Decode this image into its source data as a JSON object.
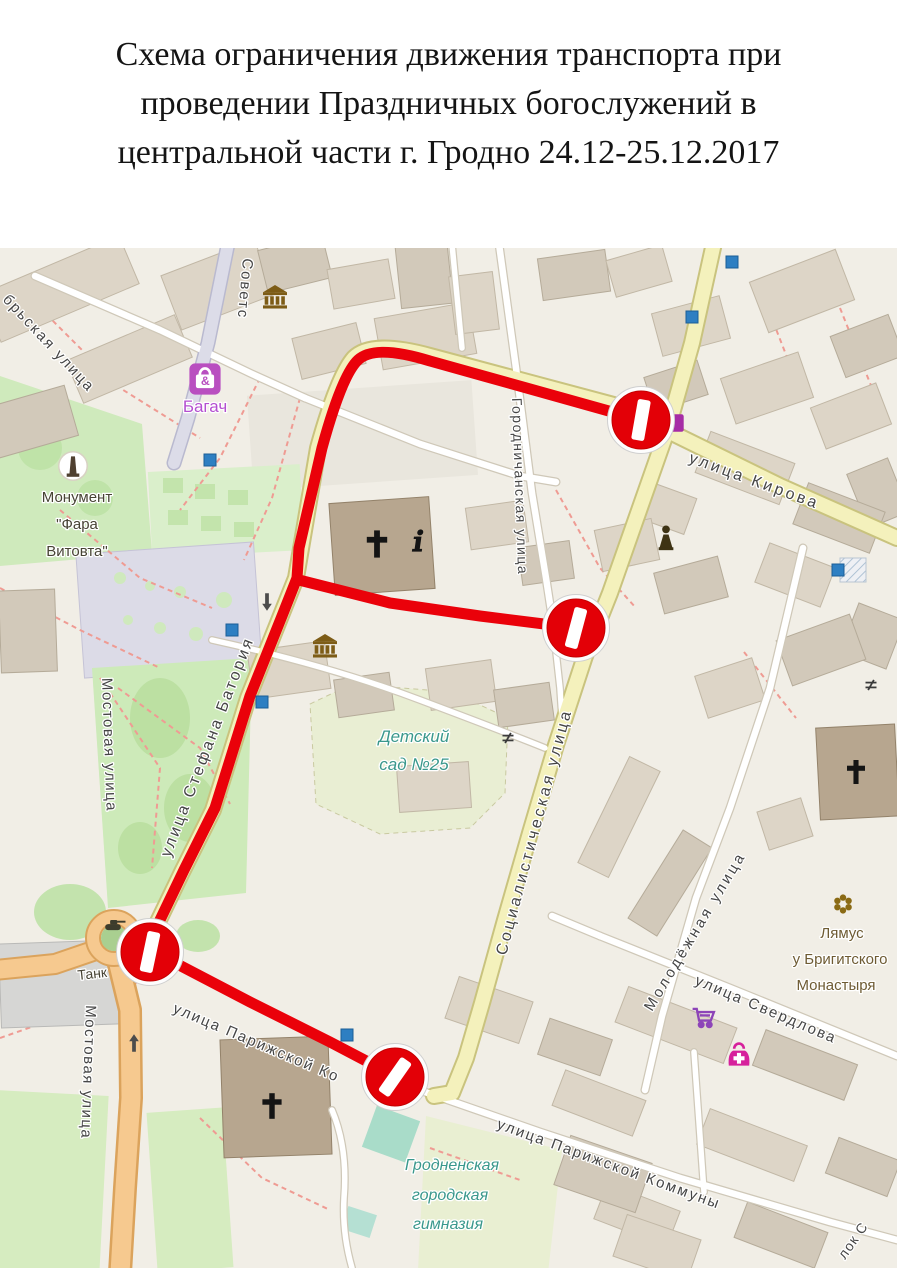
{
  "title": {
    "lines": [
      "Схема ограничения движения транспорта при",
      "проведении Праздничных богослужений в",
      "центральной части г. Гродно 24.12-25.12.2017"
    ]
  },
  "map": {
    "colors": {
      "street_text": "#454545",
      "poi_teal": "#3a988c",
      "poi_purple": "#b44fd0",
      "poi_brown": "#6e5b33",
      "poi_dark": "#474334",
      "route_red": "#ea010a",
      "sign_red": "#e30007"
    },
    "route": {
      "width": 11,
      "paths": [
        "M641,172 L430,113 Q375,96 358,112 Q342,127 322,200 L299,300 L297,330 L282,368 L250,448 L215,560 L184,622 L160,672 L152,700",
        "M299,332 L390,355 L480,368 L576,380",
        "M158,706 L250,754 L330,794 L393,827"
      ]
    },
    "no_entry_signs": [
      {
        "x": 641,
        "y": 172,
        "bar_rotate": 10
      },
      {
        "x": 576,
        "y": 380,
        "bar_rotate": 15
      },
      {
        "x": 150,
        "y": 704,
        "bar_rotate": 12
      },
      {
        "x": 395,
        "y": 829,
        "bar_rotate": 35
      }
    ],
    "labels": [
      {
        "name": "street-oktyabrskaya",
        "text": "брьская улица",
        "x": 2,
        "y": 52,
        "r": 47,
        "size": 15,
        "color": "street_text",
        "ls": 2
      },
      {
        "name": "street-sovetskaya",
        "text": "Советс",
        "x": 243,
        "y": 10,
        "r": 95,
        "size": 15,
        "color": "street_text",
        "ls": 2
      },
      {
        "name": "street-kirova",
        "text": "улица Кирова",
        "x": 688,
        "y": 214,
        "r": 20,
        "size": 16,
        "color": "street_text",
        "ls": 3
      },
      {
        "name": "street-gorodnichanskaya",
        "text": "Городничанская улица",
        "x": 512,
        "y": 150,
        "r": 88,
        "size": 14,
        "color": "street_text",
        "ls": 1.5
      },
      {
        "name": "street-stefana-batoriya",
        "text": "улица Стефана Батория",
        "x": 170,
        "y": 610,
        "r": -69,
        "size": 16,
        "color": "street_text",
        "ls": 2.5
      },
      {
        "name": "street-mostovaya-upper",
        "text": "Мостовая улица",
        "x": 102,
        "y": 430,
        "r": 88,
        "size": 15,
        "color": "street_text",
        "ls": 1.5
      },
      {
        "name": "street-mostovaya-lower",
        "text": "Мостовая улица",
        "x": 86,
        "y": 757,
        "r": 92,
        "size": 15,
        "color": "street_text",
        "ls": 1.5
      },
      {
        "name": "street-sotsialisticheskaya",
        "text": "Социалистическая улица",
        "x": 506,
        "y": 708,
        "r": -75,
        "size": 16,
        "color": "street_text",
        "ls": 3
      },
      {
        "name": "street-molodezhnaya",
        "text": "Молодёжная улица",
        "x": 652,
        "y": 764,
        "r": -59,
        "size": 15,
        "color": "street_text",
        "ls": 3
      },
      {
        "name": "street-sverdlova",
        "text": "улица Свердлова",
        "x": 694,
        "y": 736,
        "r": 23,
        "size": 15,
        "color": "street_text",
        "ls": 2
      },
      {
        "name": "street-parizhskoy-kommuny",
        "text": "улица Парижской Коммуны",
        "x": 496,
        "y": 880,
        "r": 20,
        "size": 15,
        "color": "street_text",
        "ls": 2
      },
      {
        "name": "street-parizhskoy-kommuny-west",
        "text": "улица Парижской Ко",
        "x": 172,
        "y": 764,
        "r": 23,
        "size": 15,
        "color": "street_text",
        "ls": 2,
        "layer": "under"
      },
      {
        "name": "lane-partial",
        "text": "лок С",
        "x": 845,
        "y": 1012,
        "r": -55,
        "size": 14,
        "color": "street_text",
        "ls": 1
      },
      {
        "name": "poi-monument-line1",
        "text": "Монумент",
        "x": 77,
        "y": 254,
        "size": 15,
        "color": "poi_dark",
        "anchor": "middle"
      },
      {
        "name": "poi-monument-line2",
        "text": "\"Фара",
        "x": 77,
        "y": 281,
        "size": 15,
        "color": "poi_dark",
        "anchor": "middle"
      },
      {
        "name": "poi-monument-line3",
        "text": "Витовта\"",
        "x": 77,
        "y": 308,
        "size": 15,
        "color": "poi_dark",
        "anchor": "middle"
      },
      {
        "name": "poi-bagach",
        "text": "Багач",
        "x": 205,
        "y": 164,
        "size": 17,
        "color": "poi_purple",
        "anchor": "middle"
      },
      {
        "name": "poi-detsad-line1",
        "text": "Детский",
        "x": 414,
        "y": 494,
        "size": 17,
        "color": "poi_teal",
        "anchor": "middle",
        "italic": true
      },
      {
        "name": "poi-detsad-line2",
        "text": "сад №25",
        "x": 414,
        "y": 522,
        "size": 17,
        "color": "poi_teal",
        "anchor": "middle",
        "italic": true
      },
      {
        "name": "poi-gymnasium-line1",
        "text": "Гродненская",
        "x": 452,
        "y": 922,
        "size": 16,
        "color": "poi_teal",
        "anchor": "middle",
        "italic": true
      },
      {
        "name": "poi-gymnasium-line2",
        "text": "городская",
        "x": 450,
        "y": 952,
        "size": 16,
        "color": "poi_teal",
        "anchor": "middle",
        "italic": true
      },
      {
        "name": "poi-gymnasium-line3",
        "text": "гимназия",
        "x": 448,
        "y": 981,
        "size": 16,
        "color": "poi_teal",
        "anchor": "middle",
        "italic": true
      },
      {
        "name": "poi-tank",
        "text": "Танк",
        "x": 78,
        "y": 732,
        "r": -6,
        "size": 14,
        "color": "poi_dark"
      },
      {
        "name": "poi-lyamus-line1",
        "text": "Лямус",
        "x": 842,
        "y": 690,
        "size": 15,
        "color": "poi_brown",
        "anchor": "middle"
      },
      {
        "name": "poi-lyamus-line2",
        "text": "у Бригитского",
        "x": 840,
        "y": 716,
        "size": 15,
        "color": "poi_brown",
        "anchor": "middle"
      },
      {
        "name": "poi-lyamus-line3",
        "text": "Монастыря",
        "x": 836,
        "y": 742,
        "size": 15,
        "color": "poi_brown",
        "anchor": "middle"
      }
    ],
    "icons": [
      {
        "name": "museum-icon",
        "type": "museum",
        "x": 275,
        "y": 49,
        "s": 1.2
      },
      {
        "name": "museum-icon",
        "type": "museum",
        "x": 325,
        "y": 398,
        "s": 1.2
      },
      {
        "name": "church-cross-icon",
        "type": "cross",
        "x": 377,
        "y": 296,
        "s": 1.7
      },
      {
        "name": "church-cross-icon",
        "type": "cross",
        "x": 272,
        "y": 858,
        "s": 1.6
      },
      {
        "name": "church-cross-icon",
        "type": "cross",
        "x": 856,
        "y": 524,
        "s": 1.5
      },
      {
        "name": "tourist-info-icon",
        "type": "info",
        "x": 418,
        "y": 294,
        "s": 1.5
      },
      {
        "name": "monument-icon",
        "type": "monument",
        "x": 73,
        "y": 218,
        "s": 1.5
      },
      {
        "name": "statue-icon",
        "type": "statue",
        "x": 666,
        "y": 290,
        "s": 1.6
      },
      {
        "name": "tank-monument-icon",
        "type": "tank",
        "x": 113,
        "y": 678,
        "s": 1.2
      },
      {
        "name": "shop-bag-icon",
        "type": "bag",
        "x": 205,
        "y": 131,
        "s": 1.3
      },
      {
        "name": "shopping-cart-icon",
        "type": "cart",
        "x": 703,
        "y": 770,
        "s": 1.3
      },
      {
        "name": "pharmacy-bag-icon",
        "type": "medbag",
        "x": 739,
        "y": 808,
        "s": 1.2
      },
      {
        "name": "garden-flower-icon",
        "type": "flower",
        "x": 843,
        "y": 656,
        "s": 1.6
      },
      {
        "name": "shop-icon",
        "type": "shop",
        "x": 676,
        "y": 175,
        "s": 1.1
      },
      {
        "name": "barrier-icon",
        "type": "barrier",
        "x": 871,
        "y": 437,
        "s": 1.1
      },
      {
        "name": "barrier-icon",
        "type": "barrier",
        "x": 508,
        "y": 490,
        "s": 1.1
      },
      {
        "name": "oneway-arrow-down-icon",
        "type": "arrowdown",
        "x": 267,
        "y": 354,
        "s": 1.1
      },
      {
        "name": "oneway-arrow-up-icon",
        "type": "arrowup",
        "x": 134,
        "y": 795,
        "s": 1.1
      }
    ],
    "blue_markers": [
      [
        210,
        212
      ],
      [
        232,
        382
      ],
      [
        262,
        454
      ],
      [
        732,
        14
      ],
      [
        692,
        69
      ],
      [
        838,
        322
      ],
      [
        347,
        787
      ]
    ]
  }
}
